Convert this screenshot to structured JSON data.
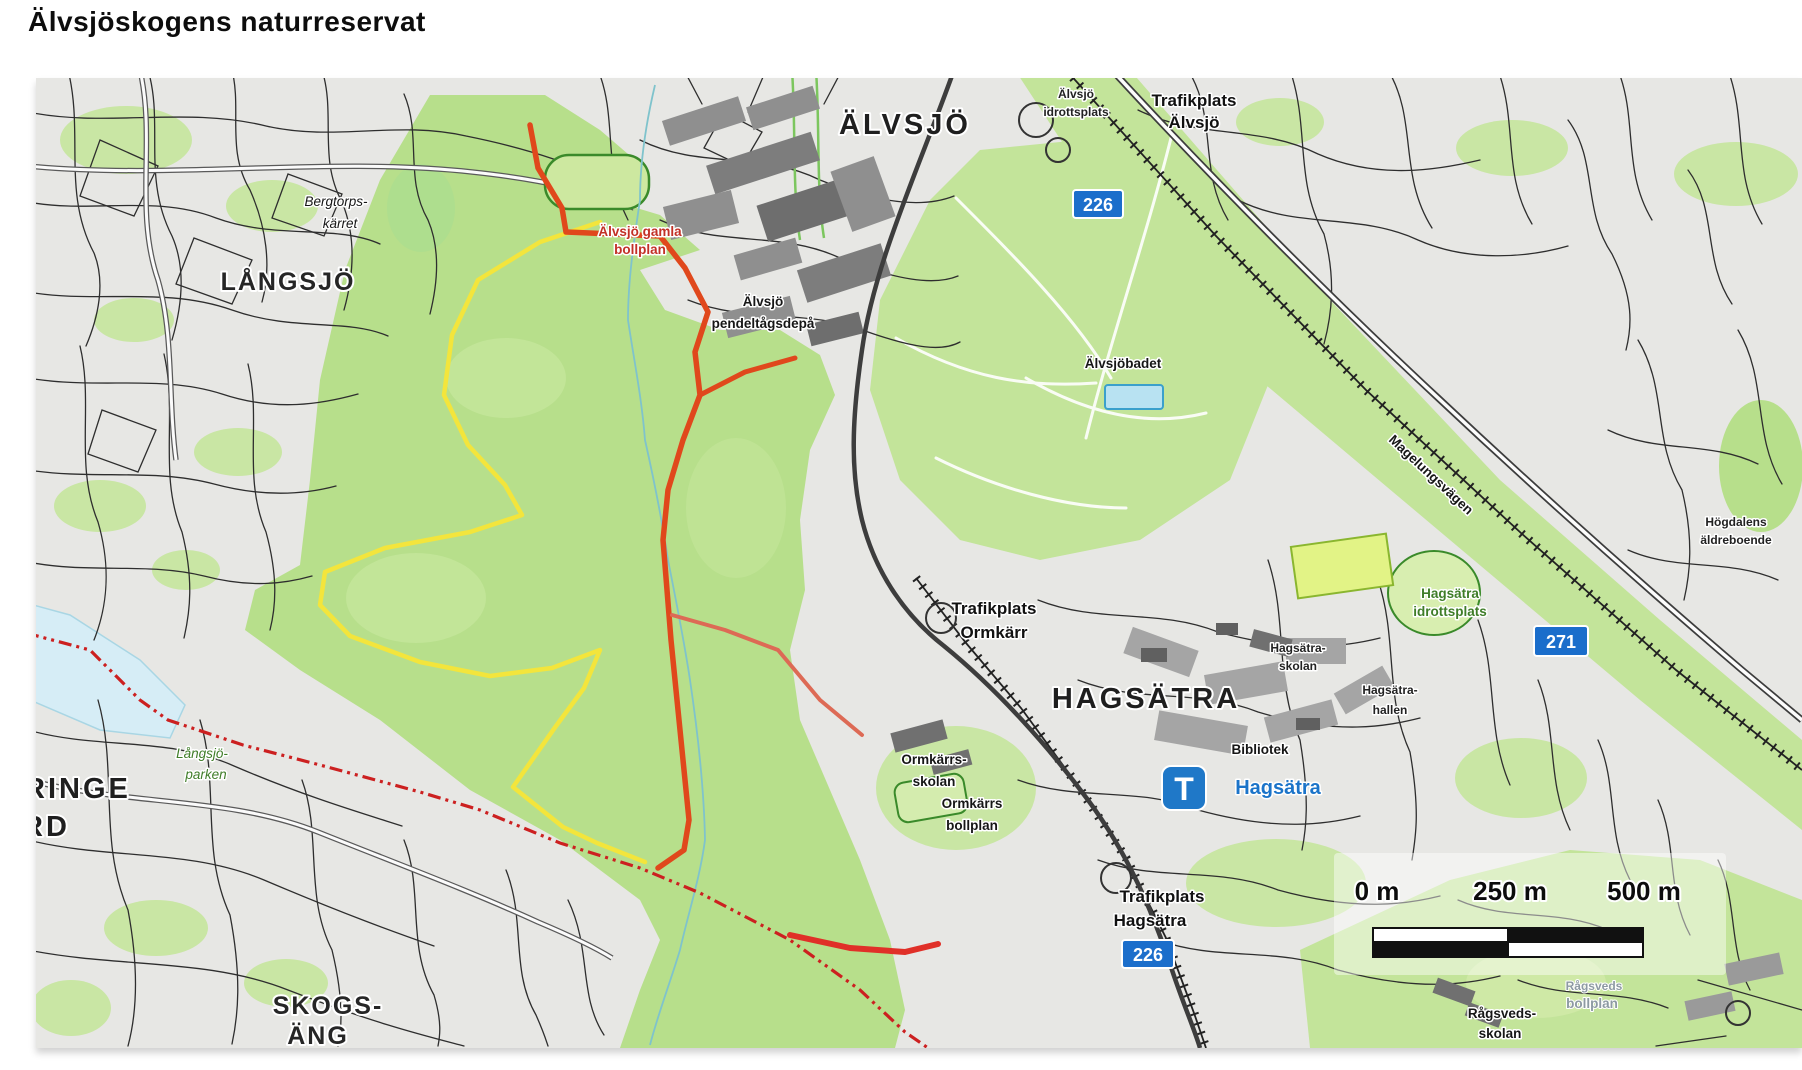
{
  "page": {
    "title": "Älvsjöskogens naturreservat"
  },
  "map": {
    "labels": {
      "alvsjo": "ÄLVSJÖ",
      "langsjo": "LÅNGSJÖ",
      "hagsatra": "HAGSÄTRA",
      "skogsang": {
        "l1": "SKOGS-",
        "l2": "ÄNG"
      },
      "juringe": {
        "l1": "RINGE",
        "l2": "RD"
      },
      "bergtorp": {
        "l1": "Bergtorps-",
        "l2": "kärret"
      },
      "alvsjo_idrottsplats": {
        "l1": "Älvsjö",
        "l2": "idrottsplats"
      },
      "trafikplats_alvsjo": {
        "l1": "Trafikplats",
        "l2": "Älvsjö"
      },
      "gamla_bollplan": {
        "l1": "Älvsjö gamla",
        "l2": "bollplan"
      },
      "depa": {
        "l1": "Älvsjö",
        "l2": "pendeltågsdepå"
      },
      "alvsjobadet": "Älvsjöbadet",
      "magelungsvagen": "Magelungsvägen",
      "hogdalen": {
        "l1": "Högdalens",
        "l2": "äldreboende"
      },
      "hagsatra_idrottsplats": {
        "l1": "Hagsätra",
        "l2": "idrottsplats"
      },
      "trafikplats_ormkarr": {
        "l1": "Trafikplats",
        "l2": "Ormkärr"
      },
      "hagsatra_skolan": {
        "l1": "Hagsätra-",
        "l2": "skolan"
      },
      "hagsatra_hallen": {
        "l1": "Hagsätra-",
        "l2": "hallen"
      },
      "bibliotek": "Bibliotek",
      "ormkarr_skolan": {
        "l1": "Ormkärrs-",
        "l2": "skolan"
      },
      "ormkarr_bollplan": {
        "l1": "Ormkärrs",
        "l2": "bollplan"
      },
      "langsjoparken": {
        "l1": "Långsjö-",
        "l2": "parken"
      },
      "trafikplats_hagsatra": {
        "l1": "Trafikplats",
        "l2": "Hagsätra"
      },
      "ragsved_skolan": {
        "l1": "Rågsveds-",
        "l2": "skolan"
      },
      "ragsved_bollplan": {
        "l1": "Rågsveds",
        "l2": "bollplan"
      }
    },
    "signs": {
      "road_226_top": "226",
      "road_271": "271",
      "road_226_bottom": "226"
    },
    "metro": {
      "symbol": "T",
      "station": "Hagsätra"
    },
    "scalebar": {
      "t0": "0 m",
      "t250": "250 m",
      "t500": "500 m"
    },
    "colors": {
      "forest_green": "#b7df8b",
      "corridor_green": "#c3e49a",
      "trail_red": "#e0481c",
      "trail_yellow": "#f3e53c",
      "boundary_red": "#cc2020",
      "water_blue": "#d6edf6",
      "stream_blue": "#7fc3cc",
      "sign_blue": "#1b6ecb",
      "metro_blue": "#1f78c8",
      "label_green": "#3f7d28",
      "label_blue": "#1b74c9",
      "label_red": "#c23026"
    }
  }
}
